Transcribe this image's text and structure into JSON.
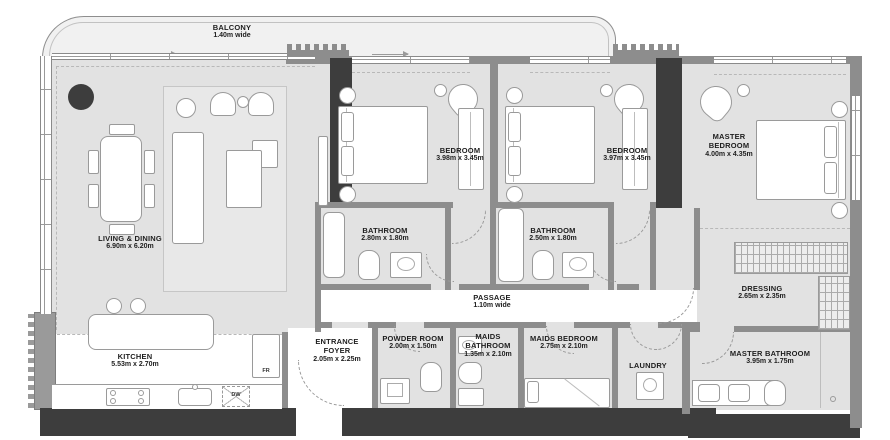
{
  "rooms": {
    "balcony": {
      "label": "BALCONY",
      "dims": "1.40m wide"
    },
    "living_dining": {
      "label": "LIVING & DINING",
      "dims": "6.90m x 6.20m"
    },
    "kitchen": {
      "label": "KITCHEN",
      "dims": "5.53m x 2.70m"
    },
    "bedroom_1": {
      "label": "BEDROOM",
      "dims": "3.98m x 3.45m"
    },
    "bedroom_2": {
      "label": "BEDROOM",
      "dims": "3.97m x 3.45m"
    },
    "master_bedroom": {
      "label": "MASTER BEDROOM",
      "dims": "4.00m x 4.35m"
    },
    "bathroom_1": {
      "label": "BATHROOM",
      "dims": "2.80m x 1.80m"
    },
    "bathroom_2": {
      "label": "BATHROOM",
      "dims": "2.50m x 1.80m"
    },
    "passage": {
      "label": "PASSAGE",
      "dims": "1.10m wide"
    },
    "dressing": {
      "label": "DRESSING",
      "dims": "2.65m x 2.35m"
    },
    "entrance_foyer": {
      "label": "ENTRANCE FOYER",
      "dims": "2.05m x 2.25m"
    },
    "powder_room": {
      "label": "POWDER ROOM",
      "dims": "2.00m x 1.50m"
    },
    "maids_bathroom": {
      "label": "MAIDS BATHROOM",
      "dims": "1.35m x 2.10m"
    },
    "maids_bedroom": {
      "label": "MAIDS BEDROOM",
      "dims": "2.75m x 2.10m"
    },
    "laundry": {
      "label": "LAUNDRY",
      "dims": ""
    },
    "master_bathroom": {
      "label": "MASTER BATHROOM",
      "dims": "3.95m x 1.75m"
    }
  },
  "appliances": {
    "fridge": "FR",
    "dishwasher": "DW"
  },
  "palette": {
    "wall_dark": "#3d3d3d",
    "wall_mid": "#8d8d8d",
    "floor": "#e2e2e2",
    "balcony_floor": "#f1f1f1",
    "text": "#1e1e1e"
  }
}
